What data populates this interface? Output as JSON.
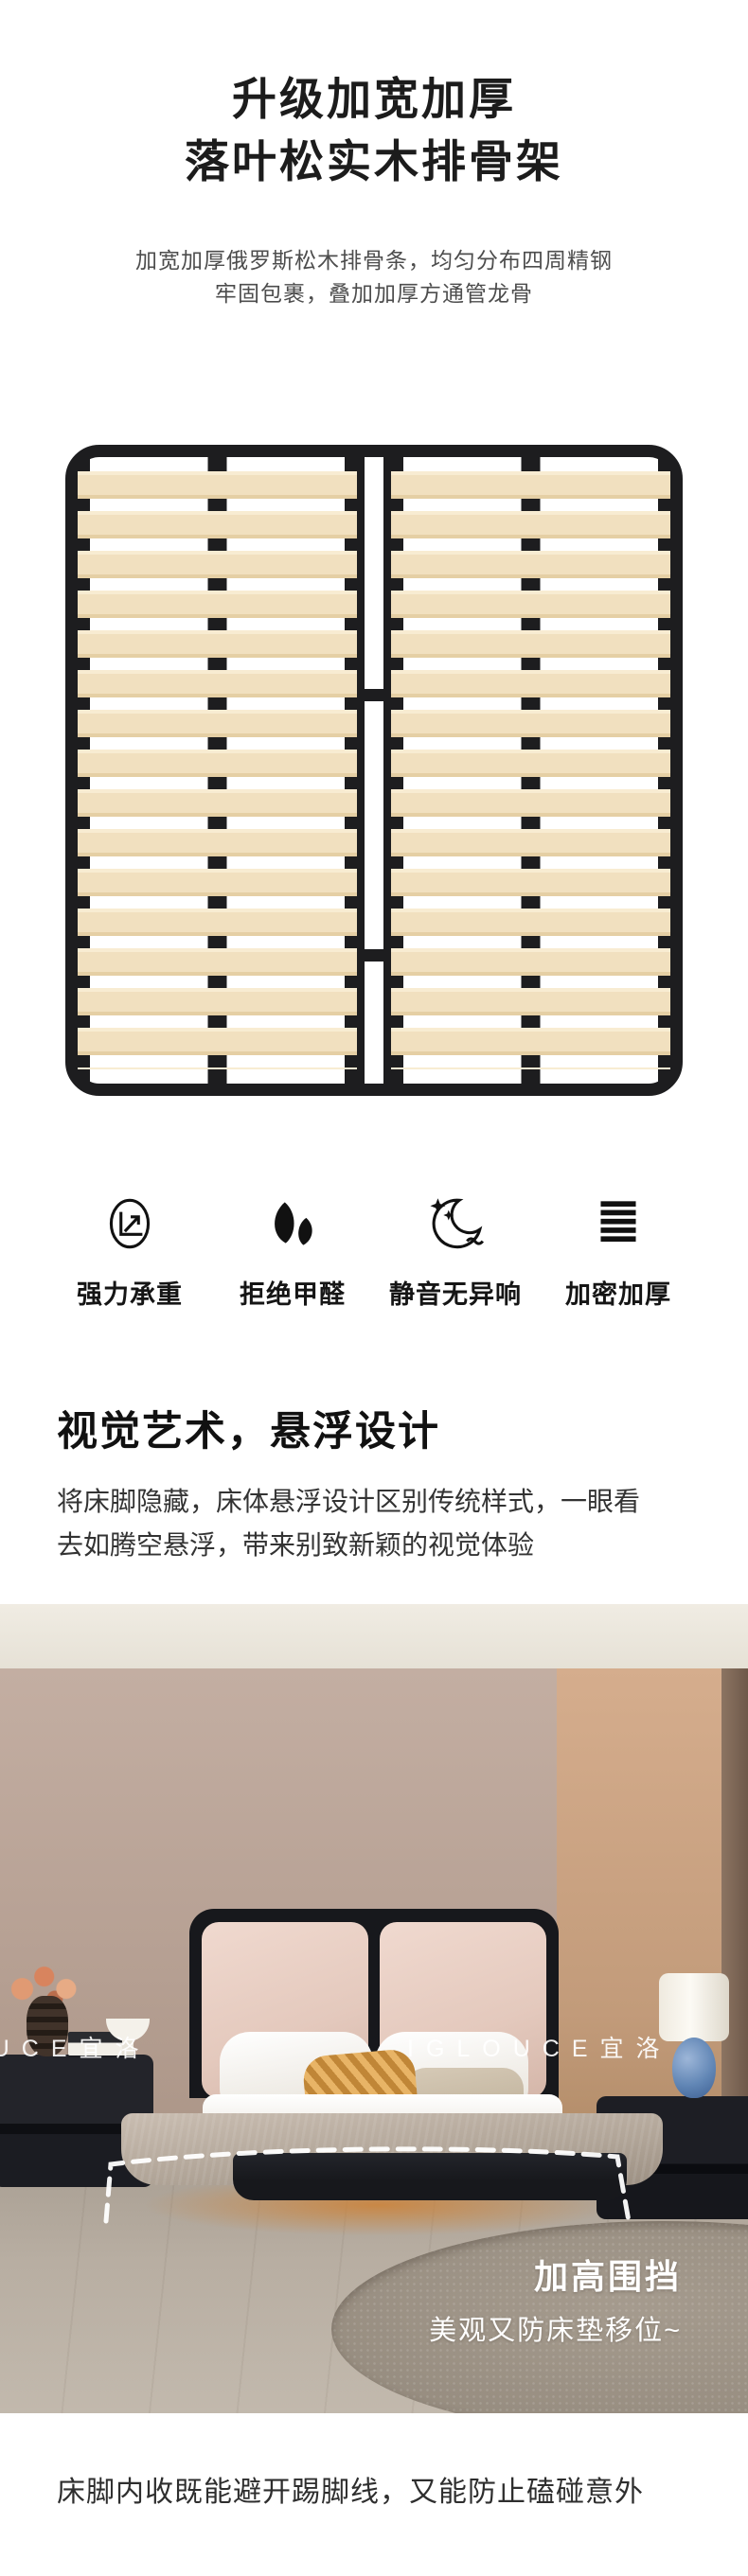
{
  "colors": {
    "page-bg": "#ffffff",
    "title": "#1c1c1c",
    "subtitle": "#4d4d4d",
    "frame-black": "#1d1d1f",
    "wood": "#f1e0bf",
    "label": "#151515",
    "body-text": "#333333",
    "wall": "#b7a194",
    "wall-right": "#c29b7a",
    "floor": "#b8aea2",
    "rug": "#968c7f",
    "bed-black": "#17181c",
    "headboard-pink": "#e4c9bd",
    "blanket": "#b0a497",
    "overlay-text": "#ffffff"
  },
  "hero": {
    "title_line1": "升级加宽加厚",
    "title_line2": "落叶松实木排骨架",
    "subtitle_line1": "加宽加厚俄罗斯松木排骨条，均匀分布四周精钢",
    "subtitle_line2": "牢固包裹，叠加加厚方通管龙骨"
  },
  "features": [
    {
      "icon": "load-bearing-icon",
      "label": "强力承重"
    },
    {
      "icon": "leaf-icon",
      "label": "拒绝甲醛"
    },
    {
      "icon": "moon-quiet-icon",
      "label": "静音无异响"
    },
    {
      "icon": "layers-icon",
      "label": "加密加厚"
    }
  ],
  "floating": {
    "heading": "视觉艺术，悬浮设计",
    "body_line1": "将床脚隐藏，床体悬浮设计区别传统样式，一眼看",
    "body_line2": "去如腾空悬浮，带来别致新颖的视觉体验"
  },
  "photo": {
    "watermark": "IGLOUCE宜洛",
    "callout_title": "加高围挡",
    "callout_subtitle": "美观又防床垫移位~"
  },
  "footer": {
    "caption": "床脚内收既能避开踢脚线，又能防止磕碰意外"
  }
}
